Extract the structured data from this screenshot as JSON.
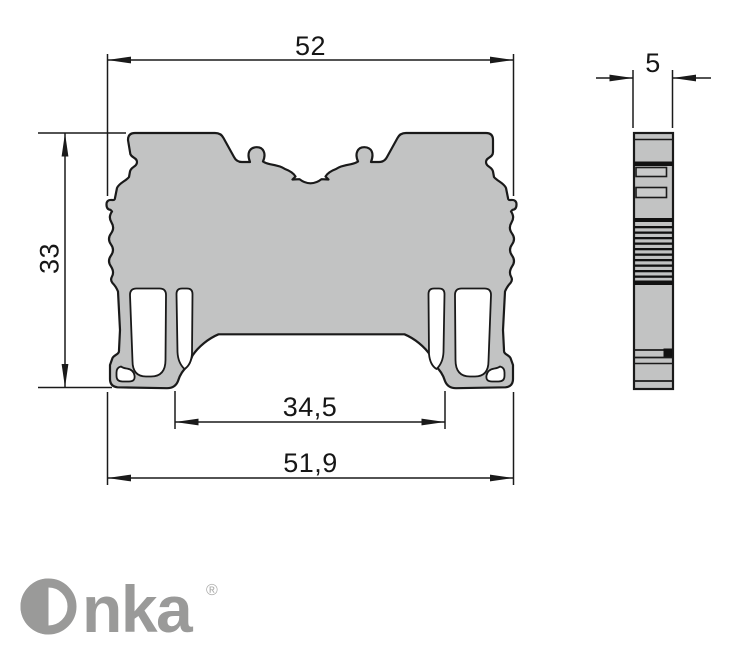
{
  "drawing": {
    "line_color": "#1a1a1a",
    "body_fill": "#c2c3c3",
    "dimensions": {
      "overall_width": "52",
      "height": "33",
      "rail_opening": "34,5",
      "base_width": "51,9",
      "thickness": "5"
    }
  },
  "logo": {
    "name": "Onka",
    "name_rest": "nka",
    "registered": "®",
    "color": "#9a9a99"
  }
}
